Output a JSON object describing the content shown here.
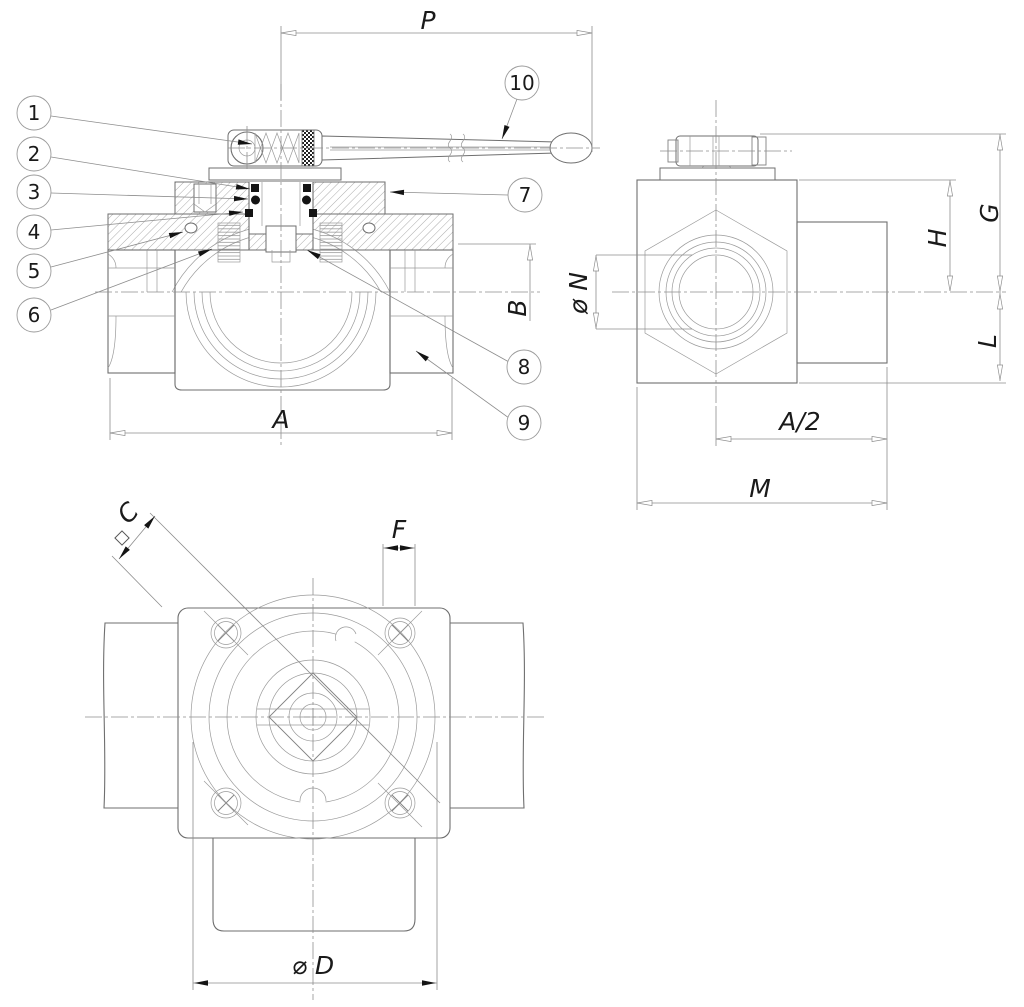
{
  "colors": {
    "background": "#ffffff",
    "line": "#6f6f6f",
    "thin_line": "#9a9a9a",
    "centerline": "#8f8f8f",
    "text": "#1a1a1a",
    "arrow_fill": "#141414"
  },
  "front_view": {
    "dim_p": "P",
    "dim_a": "A",
    "dim_b": "B",
    "balloons": [
      {
        "number": "1"
      },
      {
        "number": "2"
      },
      {
        "number": "3"
      },
      {
        "number": "4"
      },
      {
        "number": "5"
      },
      {
        "number": "6"
      },
      {
        "number": "7"
      },
      {
        "number": "8"
      },
      {
        "number": "9"
      },
      {
        "number": "10"
      }
    ]
  },
  "side_view": {
    "dim_phi_n": "ø N",
    "dim_g": "G",
    "dim_h": "H",
    "dim_l": "L",
    "dim_a_half": "A/2",
    "dim_m": "M"
  },
  "top_view": {
    "dim_c": "C",
    "dim_f": "F",
    "dim_phi_d": "⌀ D"
  }
}
